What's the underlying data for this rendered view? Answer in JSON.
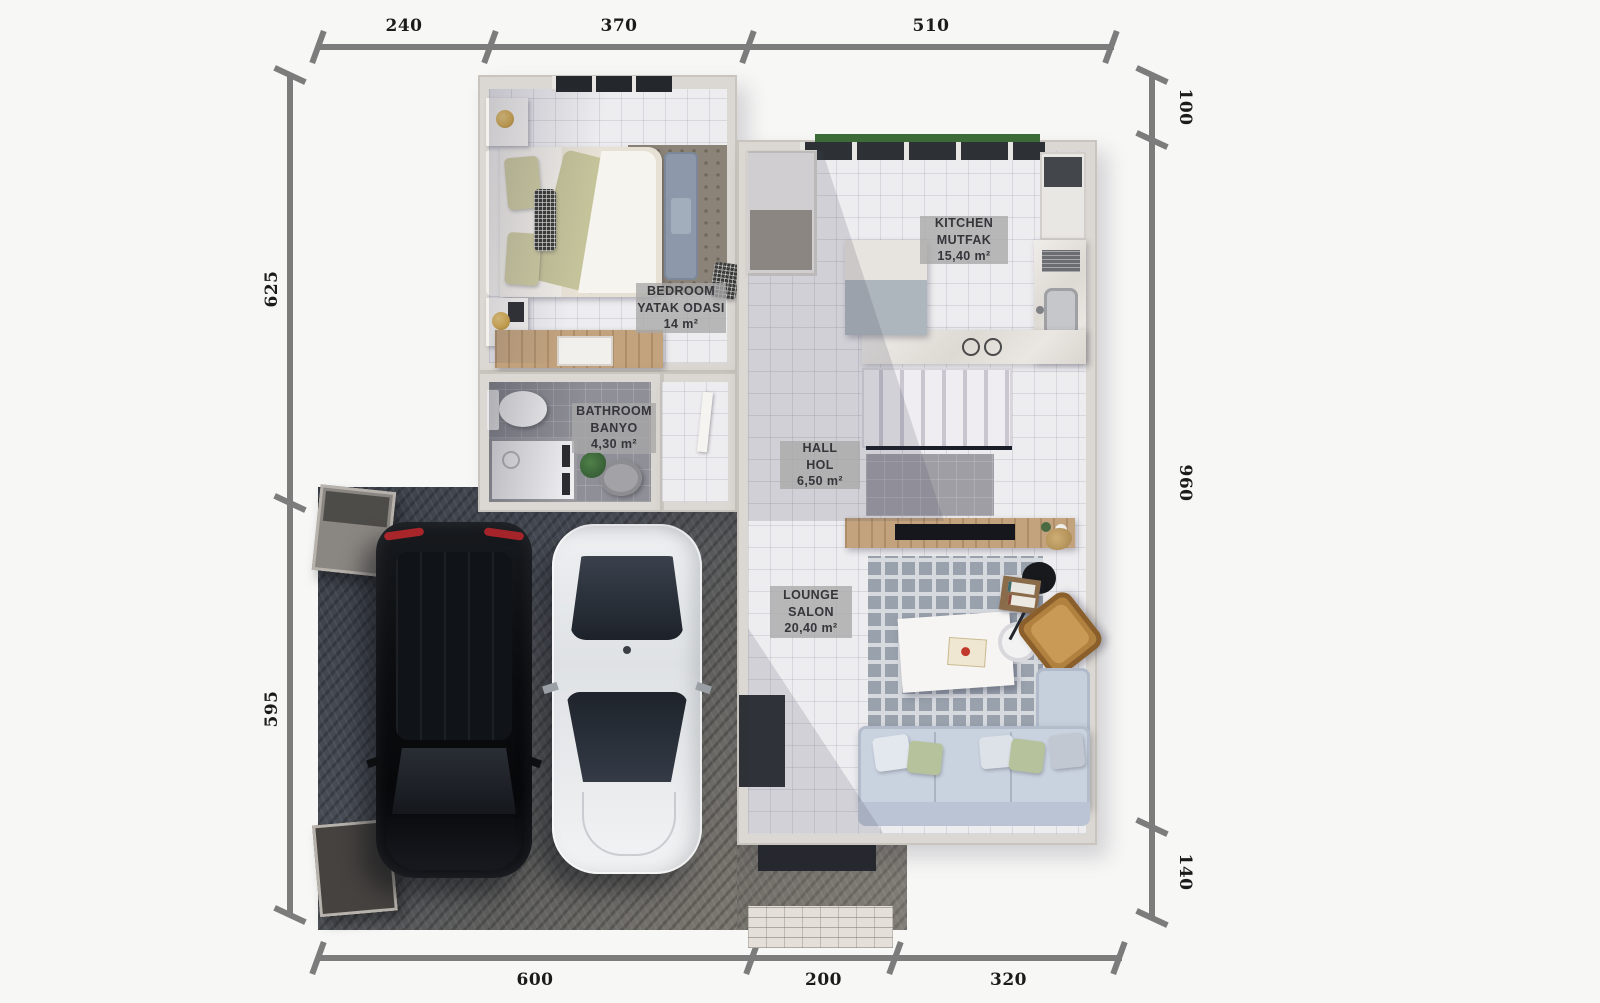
{
  "dimensions": {
    "top": [
      "240",
      "370",
      "510"
    ],
    "bottom": [
      "600",
      "200",
      "320"
    ],
    "left": [
      "625",
      "595"
    ],
    "right": [
      "100",
      "960",
      "140"
    ]
  },
  "rooms": [
    {
      "name": "KITCHEN",
      "local_name": "MUTFAK",
      "area": "15,40 m²"
    },
    {
      "name": "BEDROOM",
      "local_name": "YATAK ODASI",
      "area": "14 m²"
    },
    {
      "name": "BATHROOM",
      "local_name": "BANYO",
      "area": "4,30 m²"
    },
    {
      "name": "HALL",
      "local_name": "HOL",
      "area": "6,50 m²"
    },
    {
      "name": "LOUNGE",
      "local_name": "SALON",
      "area": "20,40 m²"
    }
  ],
  "palette": {
    "background": "#f7f7f6",
    "dimension_line": "#7c7c7c",
    "dimension_text": "#1b1b1b",
    "label_badge": "#a8a8a8",
    "label_text": "#35353a",
    "floor_tile_light": "#edecef",
    "floor_tile_dark": "#8f8f97",
    "wall": "#dbd7d2",
    "driveway_dark": "#3a3f48",
    "driveway_light": "#7e7a72",
    "wood": "#c2a37e",
    "sofa": "#c9d2df",
    "armchair": "#b0813f",
    "lounge_rug": "#99a1ad",
    "bedroom_rug": "#8b8377",
    "car_black": "#0b0d10",
    "car_white": "#e9ebed",
    "greenery": "#3c6b38",
    "lamp_gold": "#d2a94e",
    "taillight_red": "#a8252a"
  }
}
